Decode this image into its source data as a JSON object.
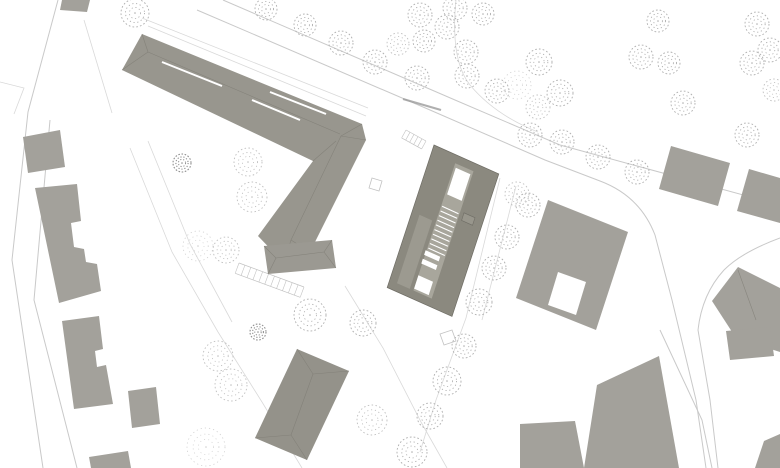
{
  "meta": {
    "canvas_width": 780,
    "canvas_height": 468,
    "drawing_kind": "architectural site plan (roof plan with context buildings, streets and trees)"
  },
  "palette": {
    "background": "#ffffff",
    "building_context": "#a3a19b",
    "building_roof": "#98968e",
    "building_main": "#8b897f",
    "building_main_strip": "#a8a69c",
    "building_main_left_strip": "#9c9a90",
    "building_south": "#94928a",
    "building_annex": "#9b9992",
    "ridge_line": "#7e7c74",
    "road_line": "#c9c9c9",
    "path_line": "#d9d9d9",
    "detail_line": "#c2c2c2",
    "tree_mid": "#aeaeae",
    "tree_light": "#bfbfbf",
    "tree_faint": "#cfcfcf",
    "tree_dark": "#8f8f8f",
    "label_stroke": "#9c9c9c"
  },
  "roads": [
    {
      "name": "main-street-upper-edge",
      "d": "M 223,0 L 455,100 L 560,145 L 780,205"
    },
    {
      "name": "main-street-lower-edge-and-branch-west",
      "d": "M 197,10 L 430,110 L 545,160 L 600,181 Q 640,196 655,235 L 672,300 L 696,400 L 706,468"
    },
    {
      "name": "branch-road-east-edge",
      "d": "M 780,238 Q 742,252 724,270 Q 702,294 698,330 L 710,400 L 718,468"
    },
    {
      "name": "west-road-outer-edge",
      "d": "M 58,0 L 28,112 L 12,260 L 43,468"
    },
    {
      "name": "west-road-inner-edge",
      "d": "M 50,120 L 34,300 L 77,468"
    },
    {
      "name": "southeast-access-road",
      "d": "M 660,330 L 702,420 L 712,468"
    }
  ],
  "paths": [
    {
      "name": "plot-line-northwest",
      "d": "M 84,20 L 112,113"
    },
    {
      "name": "courtyard-west-walk",
      "d": "M 130,148 L 172,252 L 218,332 L 262,402 L 302,468"
    },
    {
      "name": "courtyard-west-walk-inner",
      "d": "M 148,141 L 190,244 L 232,322"
    },
    {
      "name": "south-plaza-walk",
      "d": "M 345,286 L 383,348 L 421,422 L 447,468"
    },
    {
      "name": "east-alley-walk",
      "d": "M 500,178 L 466,318 L 436,400 L 420,452"
    },
    {
      "name": "east-alley-walk-inner",
      "d": "M 516,186 L 482,320"
    },
    {
      "name": "park-path",
      "d": "M 456,0 Q 450,60 470,85 Q 495,115 538,132"
    },
    {
      "name": "street-sidewalk-line",
      "d": "M 148,26 L 366,116"
    },
    {
      "name": "street-sidewalk-line-outer",
      "d": "M 142,18 L 368,108"
    },
    {
      "name": "west-plot-line",
      "d": "M 0,82 L 24,88 L 14,114"
    }
  ],
  "buildings": [
    {
      "name": "building-top-edge-small",
      "fill": "#a3a19b",
      "points": [
        [
          62,
          0
        ],
        [
          90,
          0
        ],
        [
          87,
          12
        ],
        [
          60,
          10
        ]
      ]
    },
    {
      "name": "building-l-block",
      "fill": "#98968e",
      "points": [
        [
          142,
          34
        ],
        [
          362,
          124
        ],
        [
          366,
          140
        ],
        [
          310,
          252
        ],
        [
          284,
          263
        ],
        [
          258,
          236
        ],
        [
          313,
          161
        ],
        [
          122,
          70
        ]
      ],
      "ridges": [
        [
          142,
          34,
          148,
          52
        ],
        [
          122,
          70,
          148,
          52
        ],
        [
          148,
          52,
          340,
          134
        ],
        [
          362,
          124,
          341,
          136
        ],
        [
          366,
          140,
          341,
          136
        ],
        [
          341,
          136,
          291,
          240
        ],
        [
          310,
          252,
          291,
          240
        ],
        [
          284,
          263,
          291,
          240
        ],
        [
          313,
          161,
          336,
          141
        ]
      ],
      "slits": [
        [
          162,
          62,
          222,
          86
        ],
        [
          252,
          100,
          300,
          120
        ],
        [
          270,
          92,
          326,
          114
        ]
      ]
    },
    {
      "name": "building-annex-bar",
      "fill": "#9b9992",
      "points": [
        [
          264,
          246
        ],
        [
          332,
          240
        ],
        [
          336,
          268
        ],
        [
          268,
          274
        ]
      ],
      "ridges": [
        [
          264,
          246,
          276,
          258
        ],
        [
          268,
          274,
          276,
          258
        ],
        [
          276,
          258,
          324,
          252
        ],
        [
          332,
          240,
          324,
          252
        ],
        [
          336,
          268,
          324,
          252
        ]
      ]
    },
    {
      "name": "building-south-hipped",
      "fill": "#94928a",
      "points": [
        [
          297,
          349
        ],
        [
          349,
          371
        ],
        [
          307,
          460
        ],
        [
          255,
          438
        ]
      ],
      "ridges": [
        [
          297,
          349,
          313,
          374
        ],
        [
          349,
          371,
          313,
          374
        ],
        [
          313,
          374,
          291,
          435
        ],
        [
          307,
          460,
          291,
          435
        ],
        [
          255,
          438,
          291,
          435
        ]
      ]
    },
    {
      "name": "building-west-small",
      "fill": "#a3a19b",
      "points": [
        [
          23,
          137
        ],
        [
          60,
          130
        ],
        [
          65,
          167
        ],
        [
          28,
          173
        ]
      ]
    },
    {
      "name": "building-west-long",
      "fill": "#a3a19b",
      "points": [
        [
          35,
          188
        ],
        [
          77,
          184
        ],
        [
          81,
          221
        ],
        [
          71,
          223
        ],
        [
          74,
          247
        ],
        [
          84,
          249
        ],
        [
          86,
          262
        ],
        [
          97,
          264
        ],
        [
          101,
          291
        ],
        [
          59,
          303
        ]
      ]
    },
    {
      "name": "building-west-mid",
      "fill": "#a3a19b",
      "points": [
        [
          62,
          321
        ],
        [
          99,
          316
        ],
        [
          103,
          349
        ],
        [
          95,
          351
        ],
        [
          97,
          367
        ],
        [
          106,
          365
        ],
        [
          113,
          404
        ],
        [
          74,
          409
        ]
      ]
    },
    {
      "name": "building-west-annex",
      "fill": "#a3a19b",
      "points": [
        [
          128,
          391
        ],
        [
          156,
          387
        ],
        [
          160,
          424
        ],
        [
          132,
          428
        ]
      ]
    },
    {
      "name": "building-west-south",
      "fill": "#a3a19b",
      "points": [
        [
          89,
          457
        ],
        [
          128,
          451
        ],
        [
          131,
          468
        ],
        [
          91,
          468
        ]
      ]
    },
    {
      "name": "building-northeast",
      "fill": "#a3a19b",
      "points": [
        [
          671,
          146
        ],
        [
          730,
          163
        ],
        [
          718,
          206
        ],
        [
          659,
          189
        ]
      ]
    },
    {
      "name": "building-east-edge",
      "fill": "#a3a19b",
      "points": [
        [
          749,
          169
        ],
        [
          780,
          178
        ],
        [
          780,
          223
        ],
        [
          737,
          211
        ]
      ]
    },
    {
      "name": "building-east-large",
      "fill": "#a3a19b",
      "points": [
        [
          548,
          200
        ],
        [
          628,
          232
        ],
        [
          596,
          330
        ],
        [
          516,
          298
        ]
      ]
    },
    {
      "name": "building-east-large-courtyard-cut",
      "fill": "#ffffff",
      "points": [
        [
          558,
          272
        ],
        [
          586,
          282
        ],
        [
          576,
          315
        ],
        [
          548,
          305
        ]
      ]
    },
    {
      "name": "building-southeast-diamond",
      "fill": "#a3a19b",
      "points": [
        [
          712,
          301
        ],
        [
          738,
          267
        ],
        [
          780,
          288
        ],
        [
          780,
          352
        ],
        [
          736,
          338
        ]
      ],
      "ridges": [
        [
          738,
          270,
          756,
          320
        ]
      ]
    },
    {
      "name": "building-southeast-small",
      "fill": "#a3a19b",
      "points": [
        [
          726,
          331
        ],
        [
          770,
          327
        ],
        [
          774,
          356
        ],
        [
          730,
          360
        ]
      ]
    },
    {
      "name": "building-south-east-large",
      "fill": "#a3a19b",
      "points": [
        [
          659,
          356
        ],
        [
          679,
          468
        ],
        [
          584,
          468
        ],
        [
          597,
          385
        ]
      ]
    },
    {
      "name": "building-south-east-arm",
      "fill": "#a3a19b",
      "points": [
        [
          520,
          424
        ],
        [
          575,
          421
        ],
        [
          584,
          468
        ],
        [
          520,
          468
        ]
      ]
    },
    {
      "name": "building-corner-southeast",
      "fill": "#a3a19b",
      "points": [
        [
          764,
          441
        ],
        [
          780,
          434
        ],
        [
          780,
          468
        ],
        [
          755,
          468
        ]
      ]
    }
  ],
  "stair_bump": {
    "name": "building-east-large-stair-bump",
    "cx": 586,
    "cy": 272,
    "r": 6.5,
    "fill": "#a3a19b"
  },
  "main_building": {
    "name": "building-main-new",
    "origin": [
      434,
      145
    ],
    "u": [
      0.913,
      0.407
    ],
    "v": [
      -0.312,
      0.95
    ],
    "w": 71,
    "h": 150,
    "fill": "#8b897f",
    "stroke": "#6f6d65",
    "strip": {
      "a0": 26,
      "a1": 46,
      "b0": 8,
      "b1": 142,
      "fill": "#a8a69c"
    },
    "left_strip": {
      "a0": 8,
      "a1": 22,
      "b0": 70,
      "b1": 142,
      "fill": "#9c9a90"
    },
    "skylights": [
      {
        "a0": 28,
        "a1": 44,
        "b0": 12,
        "b1": 40
      },
      {
        "a0": 26,
        "a1": 42,
        "b0": 126,
        "b1": 140
      }
    ],
    "white_bars": [
      {
        "a0": 25,
        "a1": 41,
        "b0": 100,
        "b1": 105
      },
      {
        "a0": 25,
        "a1": 41,
        "b0": 109,
        "b1": 114
      }
    ],
    "stairs": {
      "a0": 27,
      "a1": 45,
      "b0": 53,
      "b1": 97,
      "n": 9
    },
    "kiosk": {
      "a0": 50,
      "a1": 62,
      "b0": 50,
      "b1": 58,
      "stroke": "#6f6d65",
      "fill": "#98968c"
    }
  },
  "ladders": [
    {
      "name": "parking-row-street",
      "x1": 160,
      "y1": 55,
      "x2": 238,
      "y2": 77,
      "depth": 12,
      "n": 10
    },
    {
      "name": "parking-row-courtyard",
      "x1": 239,
      "y1": 263,
      "x2": 304,
      "y2": 287,
      "depth": 11,
      "n": 11
    },
    {
      "name": "entry-steps-main-building",
      "x1": 406,
      "y1": 130,
      "x2": 426,
      "y2": 141,
      "depth": 9,
      "n": 5
    }
  ],
  "squares": [
    {
      "name": "playground-square",
      "points": [
        [
          372,
          178
        ],
        [
          382,
          181
        ],
        [
          379,
          191
        ],
        [
          369,
          188
        ]
      ]
    },
    {
      "name": "plaza-square",
      "points": [
        [
          440,
          334
        ],
        [
          452,
          330
        ],
        [
          456,
          341
        ],
        [
          444,
          345
        ]
      ]
    },
    {
      "name": "courtyard-structure",
      "points": [
        [
          293,
          138
        ],
        [
          305,
          142
        ],
        [
          303,
          149
        ],
        [
          291,
          145
        ]
      ]
    }
  ],
  "street_label": {
    "name": "street-name-label",
    "x1": 403,
    "y1": 99,
    "x2": 441,
    "y2": 110,
    "note": "tiny illegible street name along road"
  },
  "trees": [
    {
      "x": 135,
      "y": 13,
      "r": 14,
      "v": "mid"
    },
    {
      "x": 266,
      "y": 9,
      "r": 11,
      "v": "mid"
    },
    {
      "x": 305,
      "y": 25,
      "r": 11,
      "v": "mid"
    },
    {
      "x": 341,
      "y": 43,
      "r": 12,
      "v": "mid"
    },
    {
      "x": 375,
      "y": 62,
      "r": 12,
      "v": "mid"
    },
    {
      "x": 398,
      "y": 44,
      "r": 11,
      "v": "light"
    },
    {
      "x": 420,
      "y": 15,
      "r": 12,
      "v": "mid"
    },
    {
      "x": 424,
      "y": 41,
      "r": 11,
      "v": "mid"
    },
    {
      "x": 417,
      "y": 78,
      "r": 12,
      "v": "mid"
    },
    {
      "x": 455,
      "y": 8,
      "r": 12,
      "v": "mid"
    },
    {
      "x": 483,
      "y": 14,
      "r": 11,
      "v": "mid"
    },
    {
      "x": 447,
      "y": 27,
      "r": 12,
      "v": "mid"
    },
    {
      "x": 466,
      "y": 52,
      "r": 12,
      "v": "mid"
    },
    {
      "x": 467,
      "y": 76,
      "r": 12,
      "v": "mid"
    },
    {
      "x": 497,
      "y": 91,
      "r": 12,
      "v": "mid"
    },
    {
      "x": 517,
      "y": 85,
      "r": 14,
      "v": "faint"
    },
    {
      "x": 539,
      "y": 62,
      "r": 13,
      "v": "mid"
    },
    {
      "x": 560,
      "y": 93,
      "r": 13,
      "v": "mid"
    },
    {
      "x": 538,
      "y": 107,
      "r": 12,
      "v": "light"
    },
    {
      "x": 641,
      "y": 57,
      "r": 12,
      "v": "mid"
    },
    {
      "x": 658,
      "y": 21,
      "r": 11,
      "v": "mid"
    },
    {
      "x": 669,
      "y": 63,
      "r": 11,
      "v": "mid"
    },
    {
      "x": 683,
      "y": 103,
      "r": 12,
      "v": "mid"
    },
    {
      "x": 757,
      "y": 24,
      "r": 12,
      "v": "mid"
    },
    {
      "x": 770,
      "y": 50,
      "r": 12,
      "v": "mid"
    },
    {
      "x": 752,
      "y": 63,
      "r": 12,
      "v": "mid"
    },
    {
      "x": 774,
      "y": 90,
      "r": 11,
      "v": "light"
    },
    {
      "x": 530,
      "y": 135,
      "r": 12,
      "v": "mid"
    },
    {
      "x": 562,
      "y": 142,
      "r": 12,
      "v": "mid"
    },
    {
      "x": 598,
      "y": 157,
      "r": 12,
      "v": "mid"
    },
    {
      "x": 637,
      "y": 172,
      "r": 12,
      "v": "mid"
    },
    {
      "x": 747,
      "y": 135,
      "r": 12,
      "v": "mid"
    },
    {
      "x": 528,
      "y": 205,
      "r": 12,
      "v": "mid"
    },
    {
      "x": 517,
      "y": 194,
      "r": 12,
      "v": "light"
    },
    {
      "x": 507,
      "y": 237,
      "r": 12,
      "v": "mid"
    },
    {
      "x": 494,
      "y": 268,
      "r": 12,
      "v": "mid"
    },
    {
      "x": 479,
      "y": 302,
      "r": 13,
      "v": "mid"
    },
    {
      "x": 464,
      "y": 346,
      "r": 12,
      "v": "mid"
    },
    {
      "x": 447,
      "y": 381,
      "r": 14,
      "v": "mid"
    },
    {
      "x": 430,
      "y": 416,
      "r": 13,
      "v": "mid"
    },
    {
      "x": 412,
      "y": 452,
      "r": 15,
      "v": "mid"
    },
    {
      "x": 248,
      "y": 162,
      "r": 14,
      "v": "light"
    },
    {
      "x": 252,
      "y": 197,
      "r": 15,
      "v": "light"
    },
    {
      "x": 182,
      "y": 163,
      "r": 9,
      "v": "dark"
    },
    {
      "x": 198,
      "y": 246,
      "r": 15,
      "v": "faint"
    },
    {
      "x": 226,
      "y": 250,
      "r": 13,
      "v": "light"
    },
    {
      "x": 310,
      "y": 315,
      "r": 16,
      "v": "mid"
    },
    {
      "x": 363,
      "y": 323,
      "r": 13,
      "v": "mid"
    },
    {
      "x": 258,
      "y": 332,
      "r": 8,
      "v": "dark"
    },
    {
      "x": 218,
      "y": 356,
      "r": 15,
      "v": "light"
    },
    {
      "x": 231,
      "y": 385,
      "r": 16,
      "v": "light"
    },
    {
      "x": 206,
      "y": 447,
      "r": 19,
      "v": "faint"
    },
    {
      "x": 372,
      "y": 420,
      "r": 15,
      "v": "light"
    }
  ]
}
